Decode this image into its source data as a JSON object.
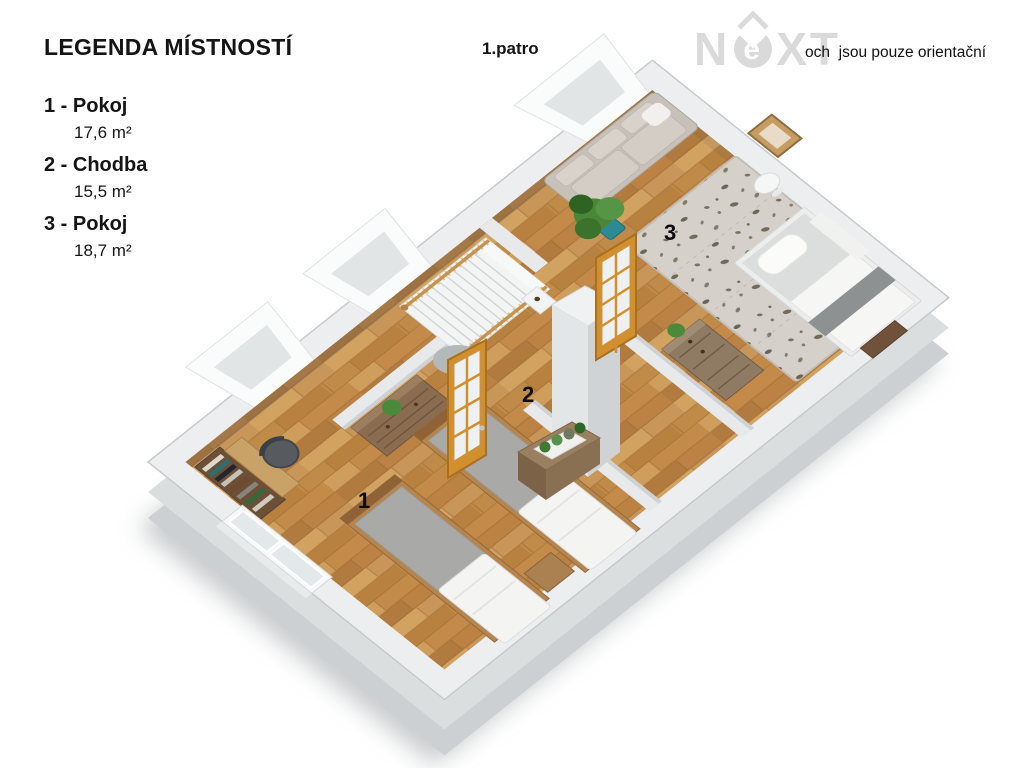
{
  "legend": {
    "title": "LEGENDA MÍSTNOSTÍ",
    "items": [
      {
        "label": "1 - Pokoj",
        "area": "17,6 m²"
      },
      {
        "label": "2 - Chodba",
        "area": "15,5 m²"
      },
      {
        "label": "3 - Pokoj",
        "area": "18,7 m²"
      }
    ]
  },
  "header": {
    "floor_label": "1.patro",
    "disclaimer": "och  jsou pouze orientační",
    "watermark": {
      "n": "N",
      "e": "e",
      "xt": "XT"
    }
  },
  "floorplan": {
    "room_labels": [
      {
        "number": "1"
      },
      {
        "number": "2"
      },
      {
        "number": "3"
      }
    ]
  },
  "colors": {
    "wall_top": "#eceeef",
    "wall_side": "#d5d8da",
    "floor_wood": "#c69352",
    "door_wood": "#d28f2e",
    "rug": "#d5d1ca",
    "plant_green": "#4a8738",
    "pot_teal": "#2b8a93"
  }
}
